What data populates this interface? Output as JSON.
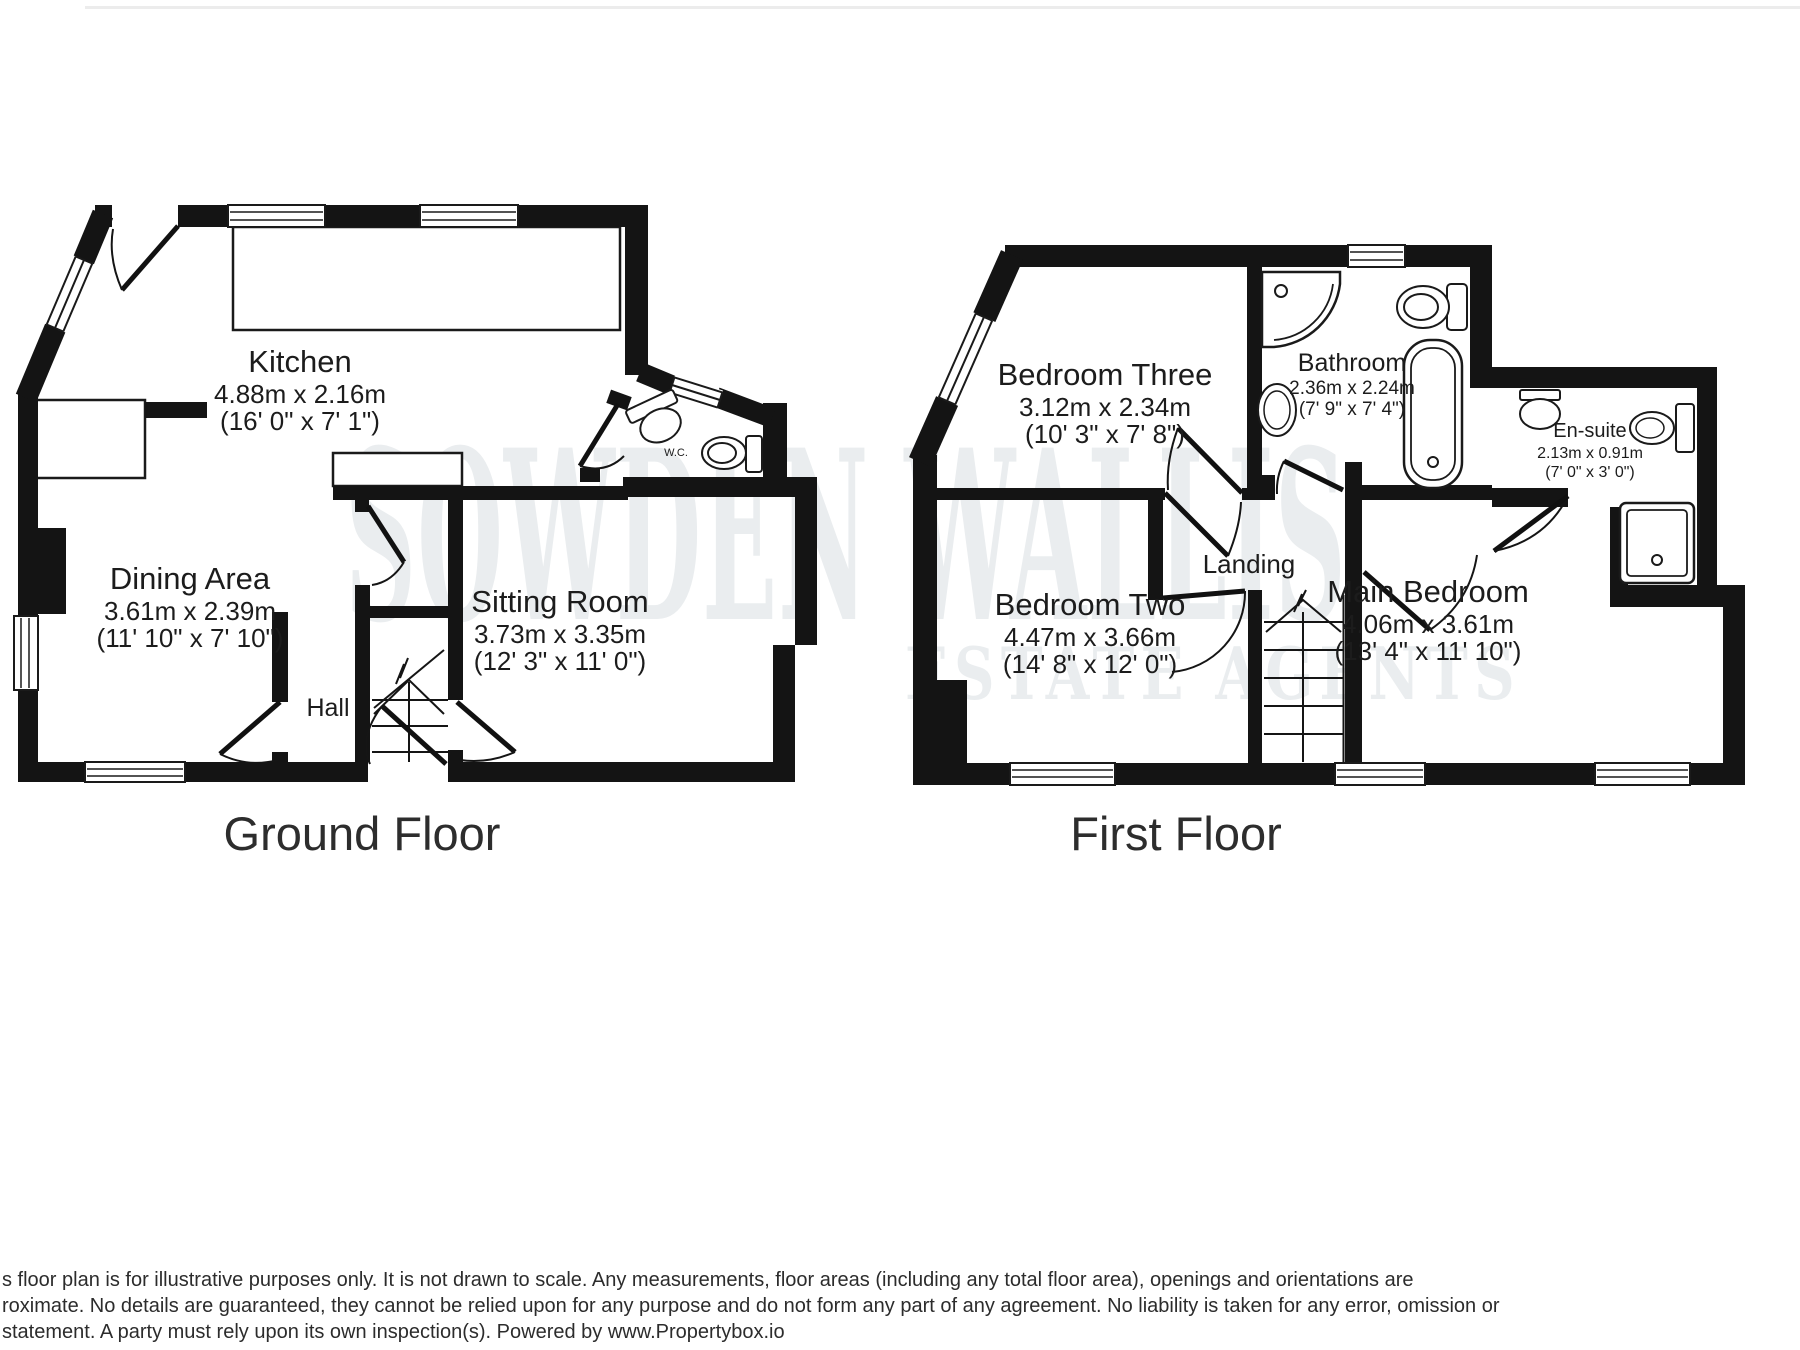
{
  "watermark": {
    "line1": "SOWDEN WALLIS",
    "line2": "ESTATE AGENTS"
  },
  "floors": {
    "ground_title": "Ground Floor",
    "first_title": "First Floor"
  },
  "rooms": {
    "kitchen": {
      "name": "Kitchen",
      "metric": "4.88m x 2.16m",
      "imperial": "(16' 0\" x 7' 1\")"
    },
    "dining": {
      "name": "Dining Area",
      "metric": "3.61m x 2.39m",
      "imperial": "(11' 10\" x 7' 10\")"
    },
    "sitting": {
      "name": "Sitting Room",
      "metric": "3.73m x 3.35m",
      "imperial": "(12' 3\" x 11' 0\")"
    },
    "hall": {
      "name": "Hall"
    },
    "wc": {
      "name": "W.C."
    },
    "bedroom_three": {
      "name": "Bedroom Three",
      "metric": "3.12m x 2.34m",
      "imperial": "(10' 3\" x 7' 8\")"
    },
    "bathroom": {
      "name": "Bathroom",
      "metric": "2.36m x 2.24m",
      "imperial": "(7' 9\" x 7' 4\")"
    },
    "ensuite": {
      "name": "En-suite",
      "metric": "2.13m x 0.91m",
      "imperial": "(7' 0\" x 3' 0\")"
    },
    "landing": {
      "name": "Landing"
    },
    "bedroom_two": {
      "name": "Bedroom Two",
      "metric": "4.47m x 3.66m",
      "imperial": "(14' 8\" x 12' 0\")"
    },
    "main_bedroom": {
      "name": "Main Bedroom",
      "metric": "4.06m x 3.61m",
      "imperial": "(13' 4\" x 11' 10\")"
    }
  },
  "disclaimer": {
    "line1": "s floor plan is for illustrative purposes only. It is not drawn to scale. Any measurements, floor areas (including any total floor area), openings and orientations are",
    "line2": "roximate. No details are guaranteed, they cannot be relied upon for any purpose and do not form any part of any agreement. No liability is taken for any error, omission or",
    "line3": "statement. A party must rely upon its own inspection(s). Powered by www.Propertybox.io"
  },
  "colors": {
    "wall": "#141414",
    "label": "#1c1c1c",
    "watermark": "#eaedef",
    "disclaimer": "#2c2c2c"
  }
}
